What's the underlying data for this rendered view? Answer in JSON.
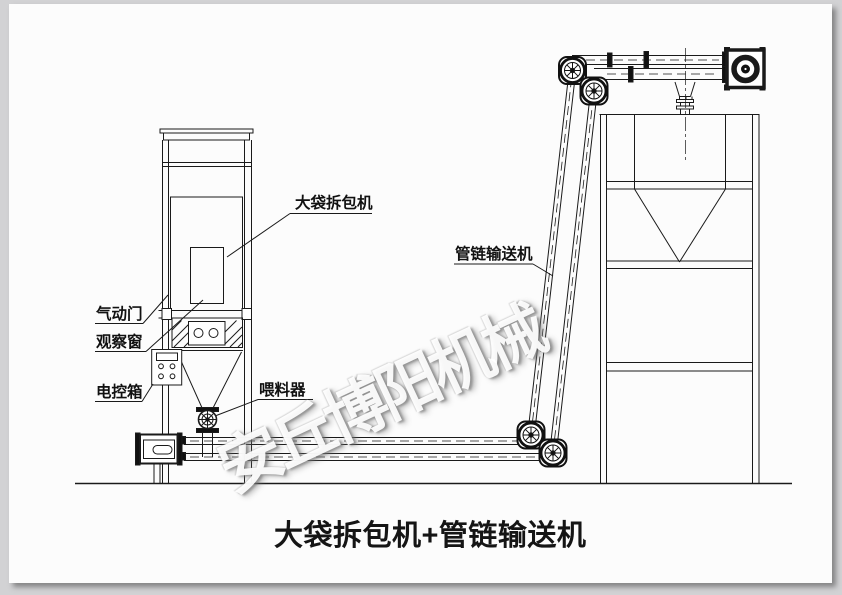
{
  "page": {
    "background_color": "#d2d2d4",
    "paper_color": "#fcfcfc",
    "line_color": "#1a1a1a"
  },
  "figure": {
    "caption": "大袋拆包机+管链输送机",
    "watermark": "安丘博阳机械",
    "labels": {
      "bag_breaker": "大袋拆包机",
      "pneumatic_door": "气动门",
      "observation_window": "观察窗",
      "control_box": "电控箱",
      "feeder": "喂料器",
      "pipe_chain_conveyor": "管链输送机"
    }
  }
}
